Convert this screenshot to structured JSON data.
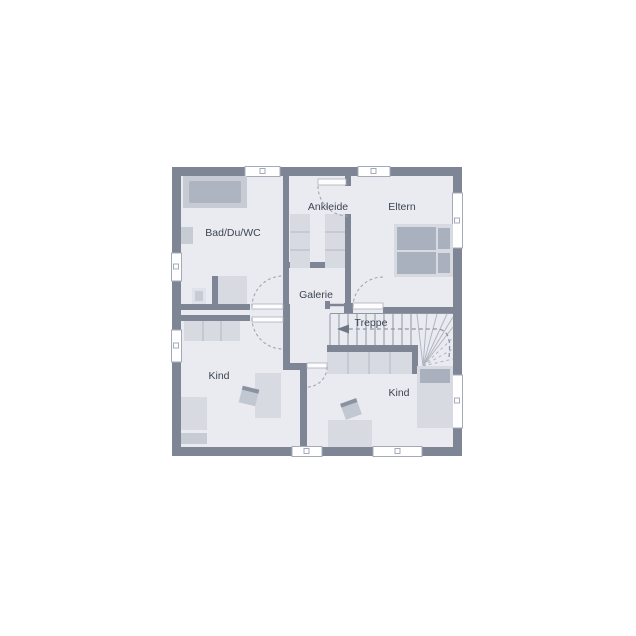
{
  "plan": {
    "type": "floor-plan",
    "rooms": [
      {
        "label": "Bad/Du/WC"
      },
      {
        "label": "Ankleide"
      },
      {
        "label": "Eltern"
      },
      {
        "label": "Galerie"
      },
      {
        "label": "Treppe"
      },
      {
        "label": "Kind"
      },
      {
        "label": "Kind"
      }
    ],
    "fixtures": [
      "bathtub",
      "washbasin",
      "toilet",
      "shower",
      "wardrobe",
      "double-bed",
      "pillow",
      "single-bed",
      "desk",
      "chair",
      "stairs",
      "winder-stairs",
      "under-stair-closet",
      "door-swing",
      "window",
      "railing",
      "direction-arrow"
    ],
    "colors": {
      "wall": "#7e8594",
      "floor": "#e9ebf0",
      "furniture_light": "#d7dae1",
      "furniture_medium": "#c6cbd4",
      "furniture_dark": "#aab1be",
      "stair_line": "#8f96a4",
      "dash_line": "#9aa1ae",
      "text": "#3e4552",
      "background": "#ffffff"
    }
  }
}
